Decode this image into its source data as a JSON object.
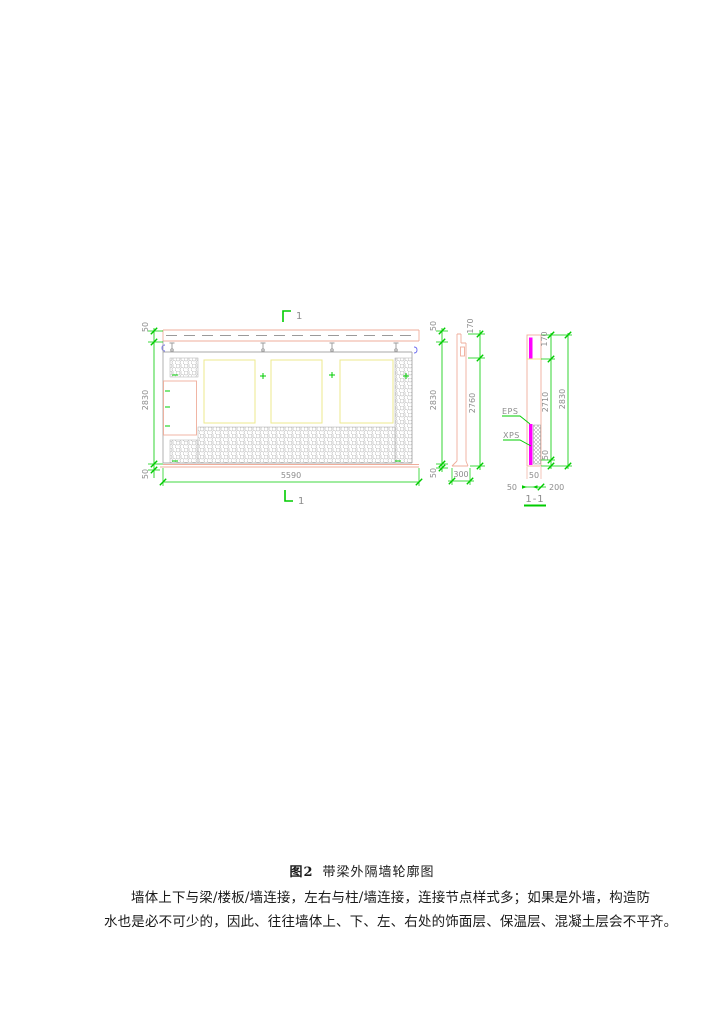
{
  "drawing": {
    "colors": {
      "dimension_green": "#00cc00",
      "annotation_gray": "#8c8c8c",
      "outline_pink": "#efad9b",
      "insulation_magenta": "#ff00ff",
      "panel_yellow": "#ecea8c",
      "reference_blue": "#6a6af0"
    },
    "section_marks": {
      "top_label": "1",
      "bottom_label": "1"
    },
    "elevation": {
      "dim_width": "5590",
      "dim_height": "2830",
      "dim_top": "50",
      "dim_bottom": "50",
      "dim_right_top": "50",
      "dim_right_height": "2830",
      "dim_right_bottom": "50"
    },
    "section": {
      "dim_notch": "170",
      "dim_inner_height": "2760",
      "dim_width": "300"
    },
    "detail": {
      "title": "1-1",
      "label_eps": "EPS",
      "label_xps": "XPS",
      "dim_top": "170",
      "dim_inner_height": "2710",
      "dim_total_height": "2830",
      "dim_bottom": "50",
      "dim_base": "50",
      "dim_finish": "50",
      "dim_wall": "200"
    }
  },
  "caption": {
    "tag": "图2",
    "title": "带梁外隔墙轮廓图"
  },
  "paragraph": {
    "line1": "墙体上下与梁/楼板/墙连接，左右与柱/墙连接，连接节点样式多；如果是外墙，构造防",
    "line2": "水也是必不可少的，因此、往往墙体上、下、左、右处的饰面层、保温层、混凝土层会不平齐。"
  }
}
